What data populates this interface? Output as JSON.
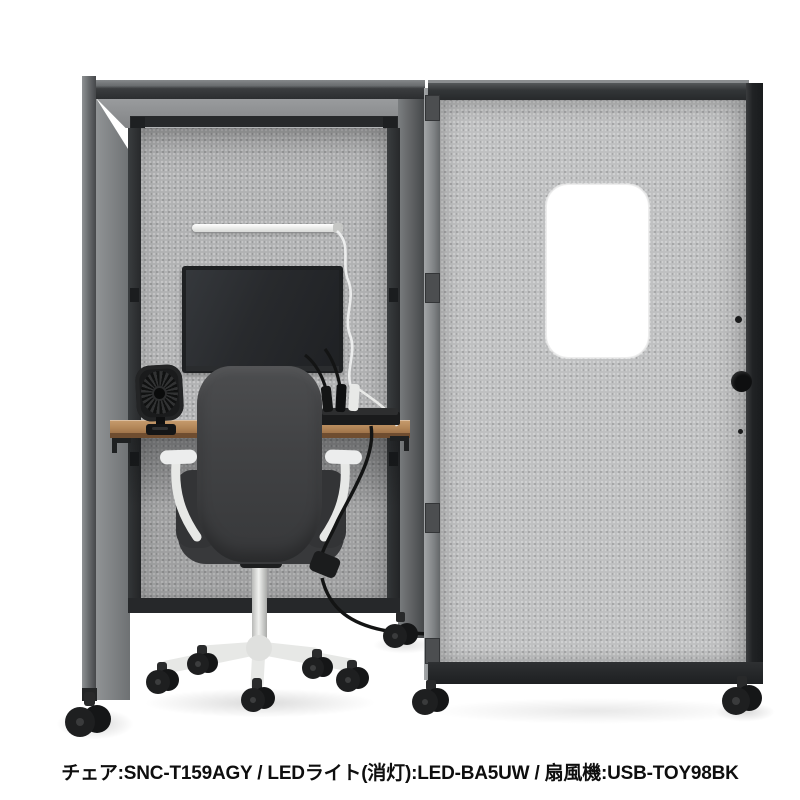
{
  "caption": {
    "text": "チェア:SNC-T159AGY / LEDライト(消灯):LED-BA5UW / 扇風機:USB-TOY98BK",
    "items": [
      {
        "label": "チェア",
        "model": "SNC-T159AGY"
      },
      {
        "label": "LEDライト(消灯)",
        "model": "LED-BA5UW"
      },
      {
        "label": "扇風機",
        "model": "USB-TOY98BK"
      }
    ],
    "separator": " / "
  },
  "scene": {
    "objects": [
      "work-booth",
      "booth-door-panel",
      "door-window-cutout",
      "door-knob",
      "office-chair",
      "desk-shelf",
      "flat-monitor",
      "led-light-bar",
      "usb-desk-fan",
      "power-strip",
      "power-cables",
      "casters"
    ],
    "colors": {
      "background": "#ffffff",
      "booth_fabric": "#b1b2b3",
      "door_fabric": "#bfc0c1",
      "frame_dark": "#2b2d2f",
      "desk_wood": "#b4885a",
      "chair_fabric": "#3f4042",
      "chair_frame_white": "#e9eae8",
      "led_bar": "#f4f4f2",
      "window_cutout": "#ffffff"
    }
  }
}
